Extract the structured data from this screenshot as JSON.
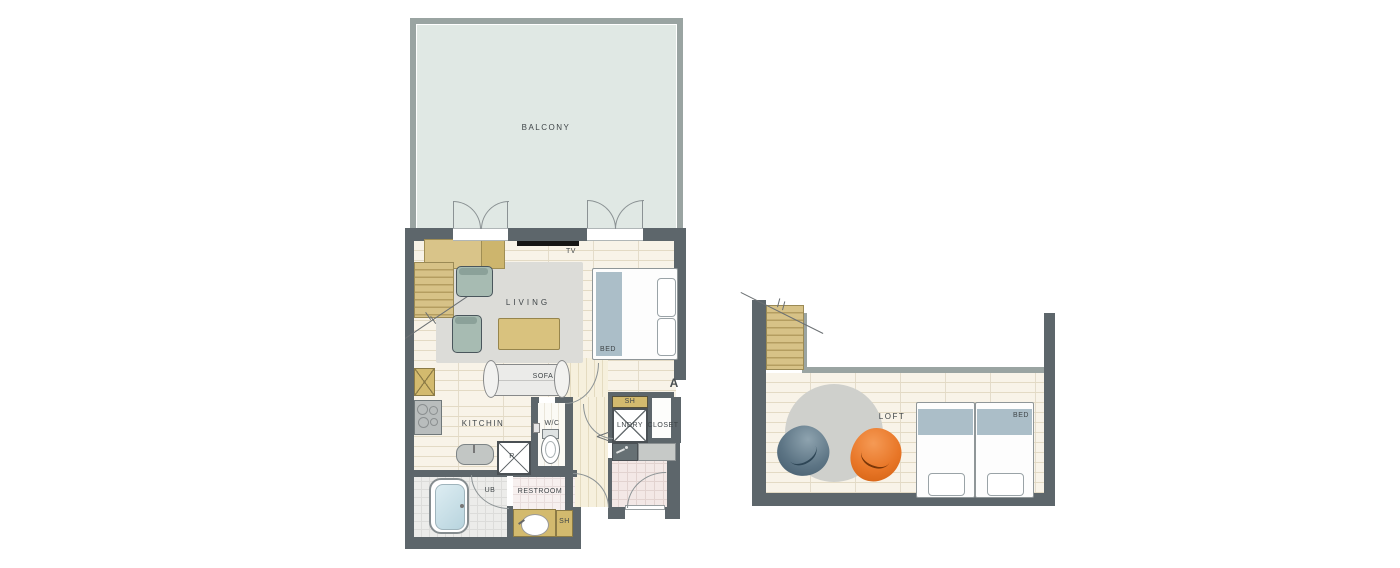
{
  "colors": {
    "wall-dark": "#5d666b",
    "wall-light": "#9aa4a2",
    "balcony-fill": "#e0e8e4",
    "line": "#8b9294",
    "label": "#3f4548",
    "wood": "#f8f3e8",
    "wood-line": "#e3dac4",
    "rug": "#dcdcd8",
    "rug-round": "#cfd0cc",
    "chair": "#a7bbb2",
    "chair-back": "#8ba199",
    "table": "#d9c27e",
    "tan": "#d3ba6e",
    "stair": "#d7c287",
    "stair-line": "#b49d60",
    "bed-band": "#abbec8",
    "beanbag-gray": "#5d7585",
    "beanbag-orange": "#e87627",
    "tv": "#151515"
  },
  "floor1": {
    "balcony_label": "BALCONY",
    "tv_label": "TV",
    "living_label": "LIVING",
    "bed_label": "BED",
    "sofa_label": "SOFA",
    "kitchen_label": "KITCHIN",
    "fridge_label": "R",
    "wc_label": "W/C",
    "shelf_top_label": "SH",
    "laundry_label": "LNDRY",
    "closet_label": "CLOSET",
    "section_label": "A",
    "ub_label": "UB",
    "restroom_label": "RESTROOM",
    "shelf_bottom_label": "SH"
  },
  "floor2": {
    "loft_label": "LOFT",
    "bed_label": "BED"
  }
}
